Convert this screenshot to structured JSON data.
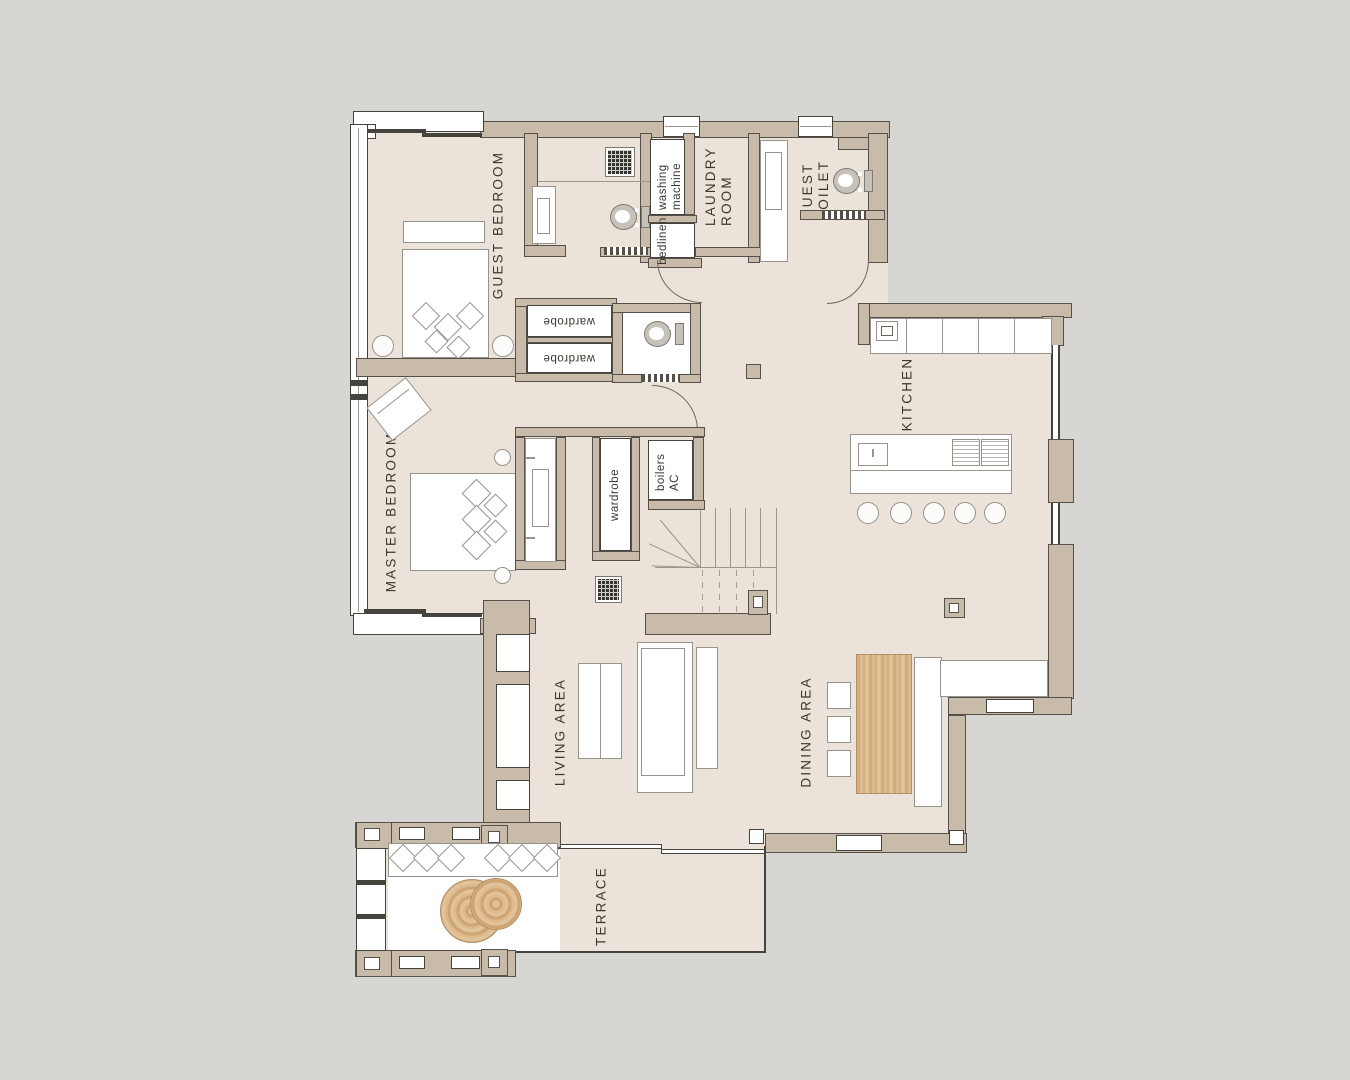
{
  "colors": {
    "background": "#d7d6d3",
    "floor": "#ebe3d9",
    "wall": "#c8bba9",
    "wood": "#d8b78a",
    "outline": "#45433e",
    "text": "#3a372f"
  },
  "rooms": {
    "guest_bedroom": {
      "label": "GUEST BEDROOM"
    },
    "master_bedroom": {
      "label": "MASTER BEDROOM"
    },
    "laundry_room": {
      "label": "LAUNDRY ROOM"
    },
    "guest_toilet": {
      "label": "GUEST TOILET"
    },
    "kitchen": {
      "label": "KITCHEN"
    },
    "living_area": {
      "label": "LIVING AREA"
    },
    "dining_area": {
      "label": "DINING AREA"
    },
    "terrace": {
      "label": "TERRACE"
    }
  },
  "storage": {
    "washing_machine": "washing machine",
    "bedlinen": "bedlinen",
    "wardrobe_hall_top": "wardrobe",
    "wardrobe_hall_bottom": "wardrobe",
    "wardrobe_master": "wardrobe",
    "boilers_ac": "boilers AC"
  }
}
